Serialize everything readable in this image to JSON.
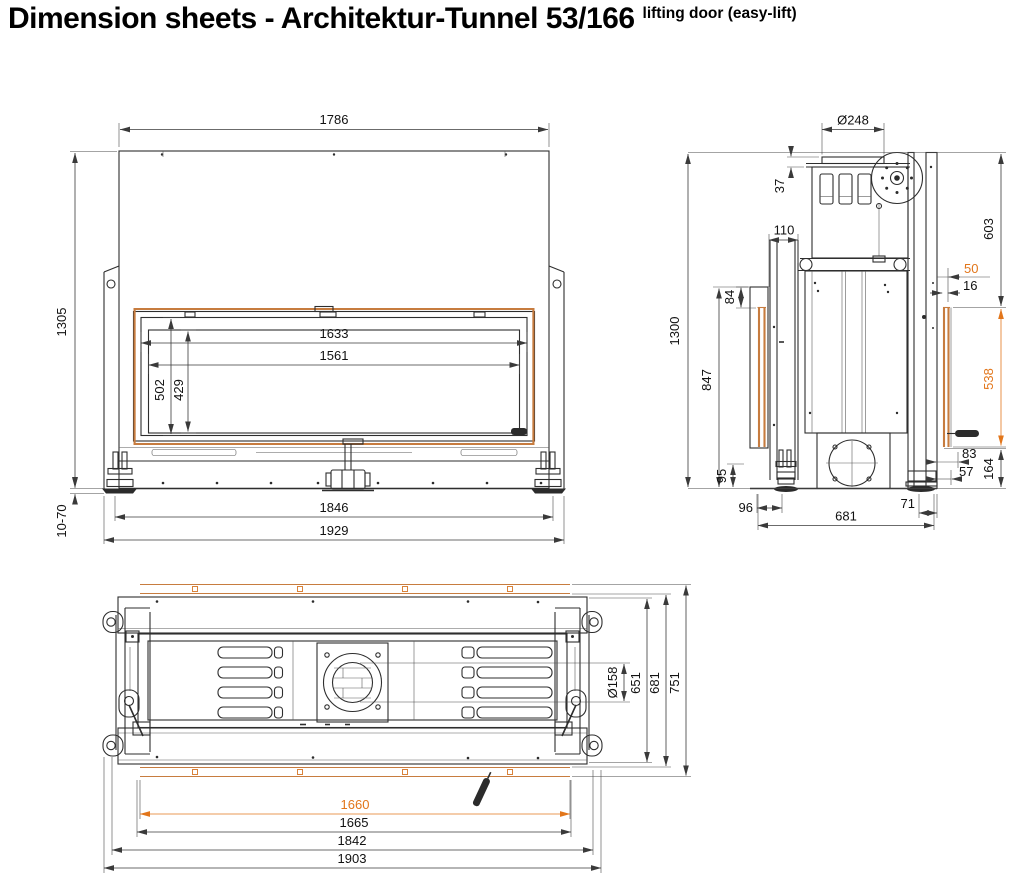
{
  "title": "Dimension sheets - Architektur-Tunnel 53/166",
  "subtitle": "lifting door (easy-lift)",
  "front": {
    "d1786": "1786",
    "d1305": "1305",
    "d1633": "1633",
    "d1561": "1561",
    "d502": "502",
    "d429": "429",
    "d1070": "10-70",
    "d1846": "1846",
    "d1929": "1929"
  },
  "side": {
    "d248": "Ø248",
    "d37": "37",
    "d110": "110",
    "d84": "84",
    "d1300": "1300",
    "d603": "603",
    "d50": "50",
    "d16": "16",
    "d847": "847",
    "d538": "538",
    "d95": "95",
    "d96": "96",
    "d681": "681",
    "d71": "71",
    "d83": "83",
    "d57": "57",
    "d164": "164"
  },
  "top": {
    "d651": "651",
    "d681": "681",
    "d751": "751",
    "d158": "Ø158",
    "d1660": "1660",
    "d1665": "1665",
    "d1842": "1842",
    "d1903": "1903"
  },
  "colors": {
    "accent_orange": "#e2761b",
    "frame_orange": "#c77c3f",
    "line": "#2e2e2e"
  }
}
